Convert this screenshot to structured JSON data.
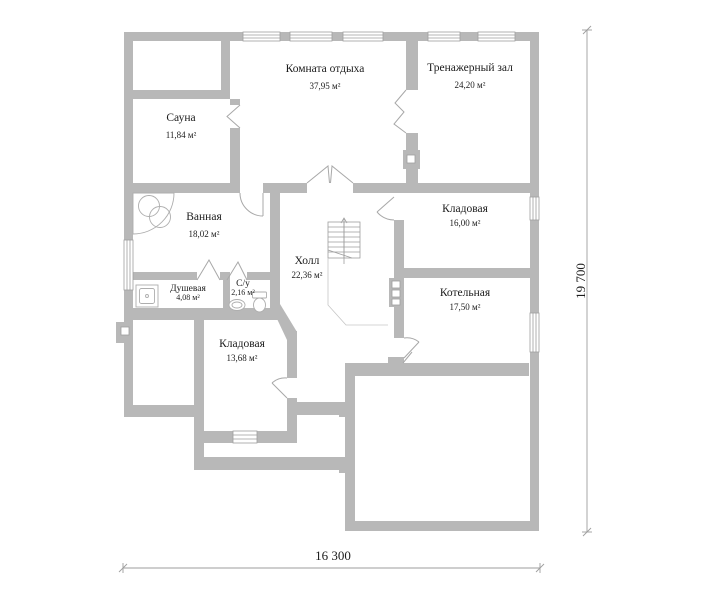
{
  "title": "Floor plan",
  "rooms": {
    "rest_room": {
      "name": "Комната отдыха",
      "area": "37,95 м²"
    },
    "gym": {
      "name": "Тренажерный зал",
      "area": "24,20 м²"
    },
    "sauna": {
      "name": "Сауна",
      "area": "11,84 м²"
    },
    "bathroom": {
      "name": "Ванная",
      "area": "18,02 м²"
    },
    "hall": {
      "name": "Холл",
      "area": "22,36 м²"
    },
    "shower": {
      "name": "Душевая",
      "area": "4,08 м²"
    },
    "wc": {
      "name": "С/у",
      "area": "2,16 м²"
    },
    "storage_small": {
      "name": "Кладовая",
      "area": "13,68 м²"
    },
    "storage_large": {
      "name": "Кладовая",
      "area": "16,00 м²"
    },
    "boiler": {
      "name": "Котельная",
      "area": "17,50 м²"
    }
  },
  "dimensions": {
    "width_label": "16 300",
    "height_label": "19 700"
  },
  "colors": {
    "wall": "#b8b8b8",
    "line": "#9e9e9e",
    "text": "#1c1c1c"
  }
}
